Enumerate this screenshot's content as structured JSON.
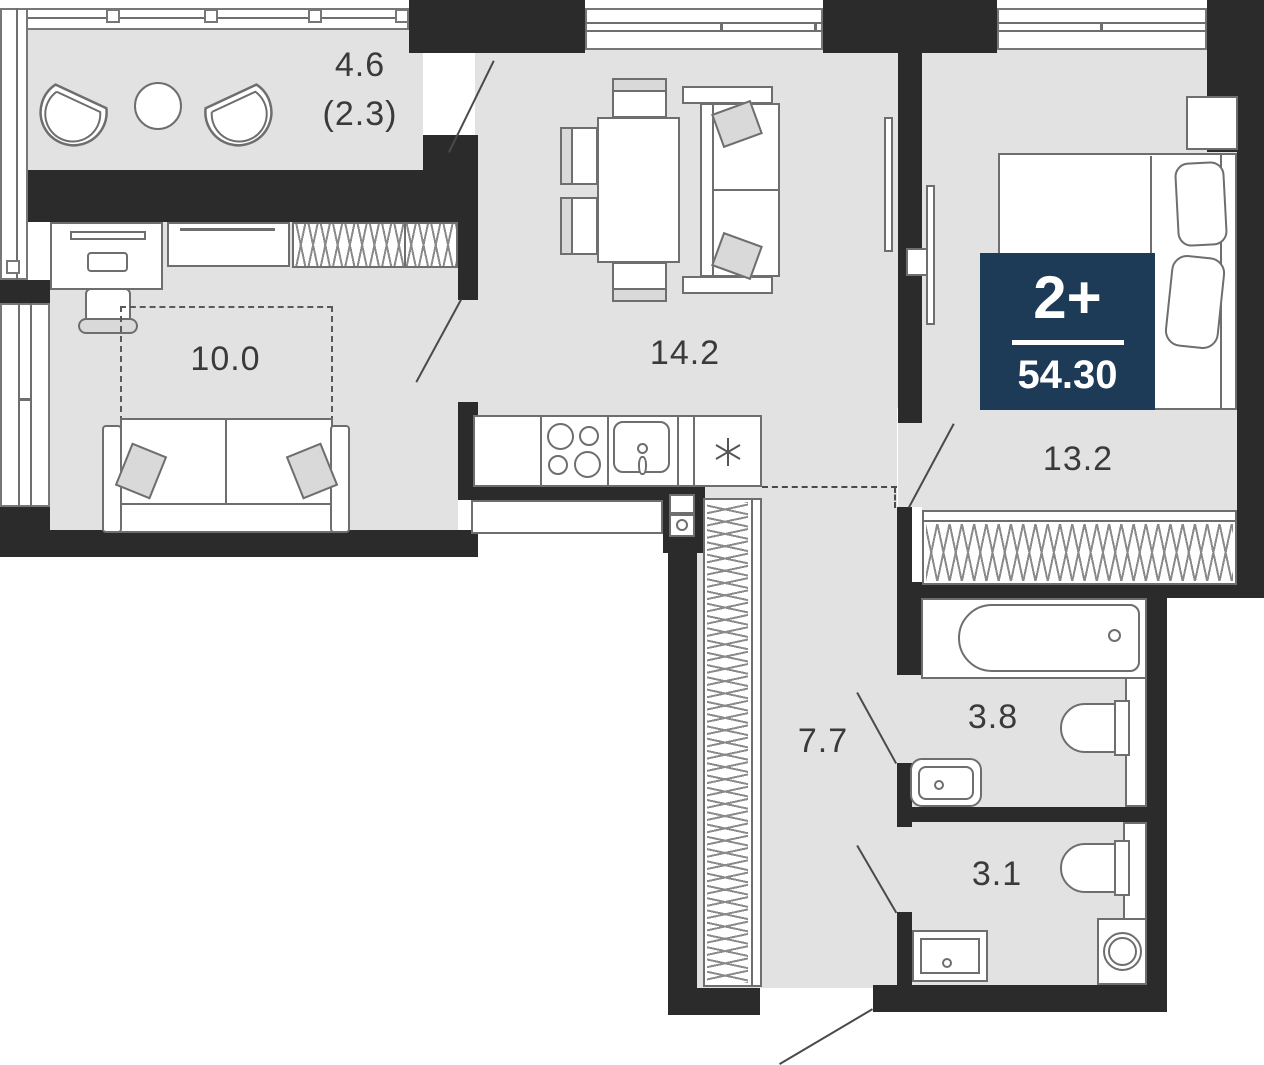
{
  "plan": {
    "badge": {
      "rooms_label": "2+",
      "area_total": "54.30"
    },
    "rooms": {
      "balcony": {
        "area": "4.6",
        "area_reduced": "(2.3)"
      },
      "bedroom_small": {
        "area": "10.0"
      },
      "kitchen_living": {
        "area": "14.2"
      },
      "bedroom": {
        "area": "13.2"
      },
      "hallway": {
        "area": "7.7"
      },
      "bathroom": {
        "area": "3.8"
      },
      "toilet": {
        "area": "3.1"
      }
    },
    "colors": {
      "wall": "#2b2b2b",
      "floor": "#e2e2e2",
      "badge_bg": "#1d3a57",
      "furniture_outline": "#6e6e6e"
    }
  }
}
